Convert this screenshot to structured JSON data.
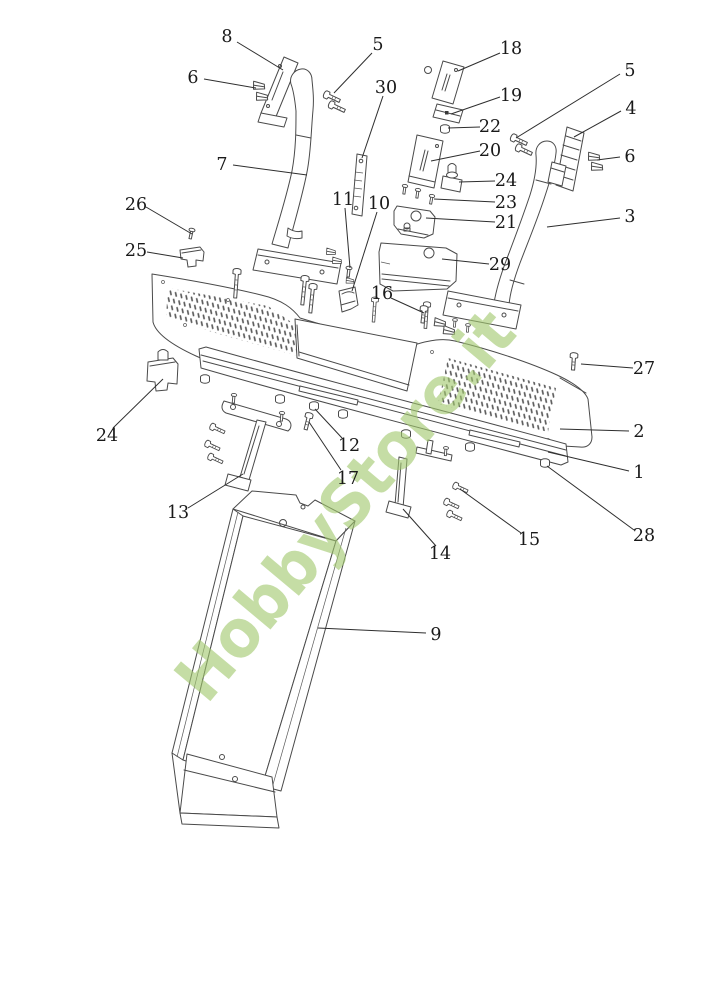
{
  "page": {
    "background": "#ffffff",
    "kind": "exploded-parts-diagram"
  },
  "watermark": {
    "text": "HobbyStore.it",
    "color": "#a2c86e",
    "opacity": 0.62
  },
  "diagram": {
    "callouts": [
      {
        "label": "8",
        "x": 227,
        "y": 36,
        "line": [
          237,
          42,
          283,
          70
        ]
      },
      {
        "label": "5",
        "x": 378,
        "y": 44,
        "line": [
          372,
          53,
          334,
          93
        ]
      },
      {
        "label": "18",
        "x": 511,
        "y": 48,
        "line": [
          500,
          53,
          458,
          71
        ]
      },
      {
        "label": "6",
        "x": 193,
        "y": 77,
        "line": [
          204,
          79,
          256,
          88
        ]
      },
      {
        "label": "30",
        "x": 386,
        "y": 87,
        "line": [
          383,
          96,
          362,
          158
        ]
      },
      {
        "label": "19",
        "x": 511,
        "y": 95,
        "line": [
          500,
          97,
          451,
          114
        ]
      },
      {
        "label": "5",
        "x": 630,
        "y": 70,
        "line": [
          620,
          74,
          516,
          138
        ]
      },
      {
        "label": "4",
        "x": 631,
        "y": 108,
        "line": [
          621,
          111,
          574,
          137
        ]
      },
      {
        "label": "22",
        "x": 490,
        "y": 126,
        "line": [
          480,
          127,
          448,
          128
        ]
      },
      {
        "label": "20",
        "x": 490,
        "y": 150,
        "line": [
          480,
          151,
          431,
          161
        ]
      },
      {
        "label": "6",
        "x": 630,
        "y": 156,
        "line": [
          620,
          157,
          597,
          160
        ]
      },
      {
        "label": "7",
        "x": 222,
        "y": 164,
        "line": [
          233,
          165,
          307,
          175
        ]
      },
      {
        "label": "24",
        "x": 506,
        "y": 180,
        "line": [
          495,
          181,
          459,
          182
        ]
      },
      {
        "label": "23",
        "x": 506,
        "y": 202,
        "line": [
          495,
          202,
          434,
          199
        ]
      },
      {
        "label": "26",
        "x": 136,
        "y": 204,
        "line": [
          146,
          207,
          192,
          234
        ]
      },
      {
        "label": "3",
        "x": 630,
        "y": 216,
        "line": [
          620,
          218,
          547,
          227
        ]
      },
      {
        "label": "21",
        "x": 506,
        "y": 222,
        "line": [
          495,
          222,
          426,
          218
        ]
      },
      {
        "label": "11",
        "x": 343,
        "y": 199,
        "line": [
          345,
          208,
          350,
          268
        ]
      },
      {
        "label": "10",
        "x": 379,
        "y": 203,
        "line": [
          377,
          212,
          352,
          291
        ]
      },
      {
        "label": "25",
        "x": 136,
        "y": 250,
        "line": [
          147,
          252,
          183,
          258
        ]
      },
      {
        "label": "29",
        "x": 500,
        "y": 264,
        "line": [
          489,
          264,
          442,
          259
        ]
      },
      {
        "label": "16",
        "x": 382,
        "y": 293,
        "line": [
          391,
          298,
          424,
          313
        ]
      },
      {
        "label": "27",
        "x": 644,
        "y": 368,
        "line": [
          633,
          368,
          581,
          364
        ]
      },
      {
        "label": "24",
        "x": 107,
        "y": 435,
        "line": [
          113,
          428,
          163,
          379
        ]
      },
      {
        "label": "2",
        "x": 639,
        "y": 431,
        "line": [
          629,
          431,
          560,
          429
        ]
      },
      {
        "label": "12",
        "x": 349,
        "y": 445,
        "line": [
          342,
          438,
          315,
          409
        ]
      },
      {
        "label": "1",
        "x": 639,
        "y": 472,
        "line": [
          629,
          471,
          548,
          452
        ]
      },
      {
        "label": "17",
        "x": 348,
        "y": 478,
        "line": [
          341,
          470,
          309,
          422
        ]
      },
      {
        "label": "13",
        "x": 178,
        "y": 512,
        "line": [
          188,
          508,
          243,
          474
        ]
      },
      {
        "label": "15",
        "x": 529,
        "y": 539,
        "line": [
          521,
          533,
          460,
          489
        ]
      },
      {
        "label": "28",
        "x": 644,
        "y": 535,
        "line": [
          634,
          530,
          547,
          466
        ]
      },
      {
        "label": "14",
        "x": 440,
        "y": 553,
        "line": [
          436,
          546,
          403,
          509
        ]
      },
      {
        "label": "9",
        "x": 436,
        "y": 634,
        "line": [
          426,
          633,
          318,
          628
        ]
      }
    ]
  }
}
